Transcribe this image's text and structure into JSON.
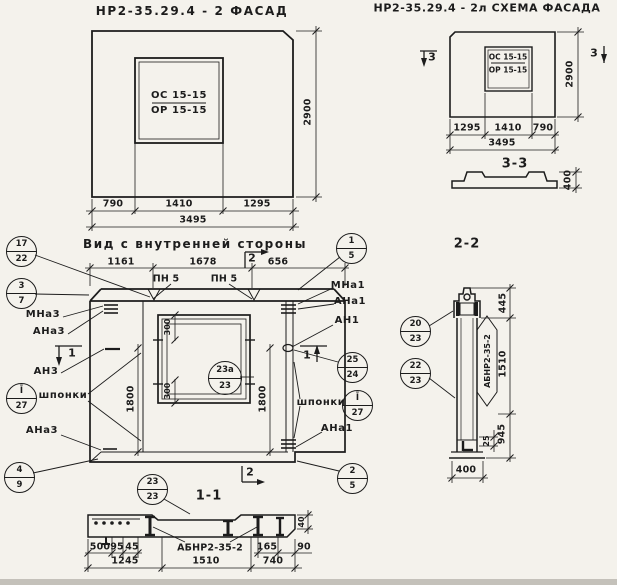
{
  "facade": {
    "title": "НР2-35.29.4 - 2 ФАСАД",
    "window_top": "ОС 15-15",
    "window_bottom": "ОР 15-15",
    "dim_left": "790",
    "dim_mid": "1410",
    "dim_right": "1295",
    "dim_total": "3495",
    "dim_height": "2900"
  },
  "schema": {
    "title": "НР2-35.29.4 - 2л СХЕМА ФАСАДА",
    "window_top": "ОС 15-15",
    "window_bottom": "ОР 15-15",
    "dim_left": "1295",
    "dim_mid": "1410",
    "dim_right": "790",
    "dim_total": "3495",
    "dim_height": "2900",
    "marker_left": "3",
    "marker_right": "3",
    "section_title": "3-3",
    "section_height": "400"
  },
  "inner": {
    "title": "Вид с внутренней стороны",
    "dim_top_left": "1161",
    "dim_top_mid": "1678",
    "dim_top_right": "656",
    "pn_label_1": "ПН 5",
    "pn_label_2": "ПН 5",
    "marker_top": "2",
    "marker_bottom": "2",
    "marker_left": "1",
    "marker_right": "1",
    "dim_300_top": "300",
    "dim_300_bottom": "300",
    "dim_1800_left": "1800",
    "dim_1800_right": "1800",
    "labels": {
      "mna3": "МНа3",
      "ana3": "АНа3",
      "an3": "АН3",
      "shponki_left": "шпонки",
      "ana3_low": "АНа3",
      "mna1": "МНа1",
      "ana1": "АНа1",
      "an1": "АН1",
      "shponki_right": "шпонки",
      "ana1_low": "АНа1"
    },
    "callouts": {
      "c17": {
        "top": "17",
        "bottom": "22"
      },
      "c3": {
        "top": "3",
        "bottom": "7"
      },
      "c27l": {
        "top": "Ī",
        "bottom": "27"
      },
      "c4": {
        "top": "4",
        "bottom": "9"
      },
      "c1": {
        "top": "1",
        "bottom": "5"
      },
      "c25": {
        "top": "25",
        "bottom": "24"
      },
      "c27r": {
        "top": "Ī",
        "bottom": "27"
      },
      "c2": {
        "top": "2",
        "bottom": "5"
      },
      "c23a": {
        "top": "23а",
        "bottom": "23"
      }
    }
  },
  "section22": {
    "title": "2-2",
    "label": "АБНР2-35-2",
    "c20": {
      "top": "20",
      "bottom": "23"
    },
    "c22": {
      "top": "22",
      "bottom": "23"
    },
    "dim_445": "445",
    "dim_1510": "1510",
    "dim_945": "945",
    "dim_25": "25",
    "dim_400": "400"
  },
  "section11": {
    "title": "1-1",
    "label": "АБНР2-35-2",
    "c23": {
      "top": "23",
      "bottom": "23"
    },
    "dims": {
      "d500": "500",
      "d95": "95",
      "d45": "45",
      "d1245": "1245",
      "d1510": "1510",
      "d740": "740",
      "d165": "165",
      "d90": "90",
      "d40": "40"
    }
  }
}
